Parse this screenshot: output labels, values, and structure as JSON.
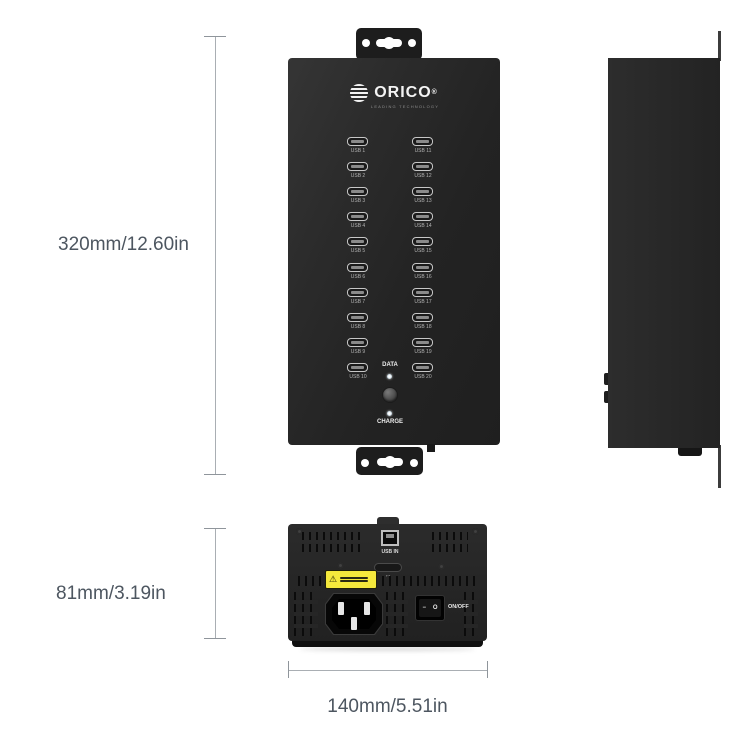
{
  "product": {
    "brand": "ORICO",
    "registered": "®",
    "tagline": "LEADING TECHNOLOGY"
  },
  "dimensions": {
    "front_height": "320mm/12.60in",
    "rear_height": "81mm/3.19in",
    "width": "140mm/5.51in"
  },
  "front_view": {
    "left_ports": [
      "USB 1",
      "USB 2",
      "USB 3",
      "USB 4",
      "USB 5",
      "USB 6",
      "USB 7",
      "USB 8",
      "USB 9",
      "USB 10"
    ],
    "right_ports": [
      "USB 11",
      "USB 12",
      "USB 13",
      "USB 14",
      "USB 15",
      "USB 16",
      "USB 17",
      "USB 18",
      "USB 19",
      "USB 20"
    ],
    "data_label": "DATA",
    "charge_label": "CHARGE"
  },
  "rear_view": {
    "usb_in_label": "USB IN",
    "switch_label": "ON/OFF",
    "rocker_on": "−",
    "rocker_off": "O",
    "warning_icon": "⚠",
    "arrow_mark": "↔"
  }
}
